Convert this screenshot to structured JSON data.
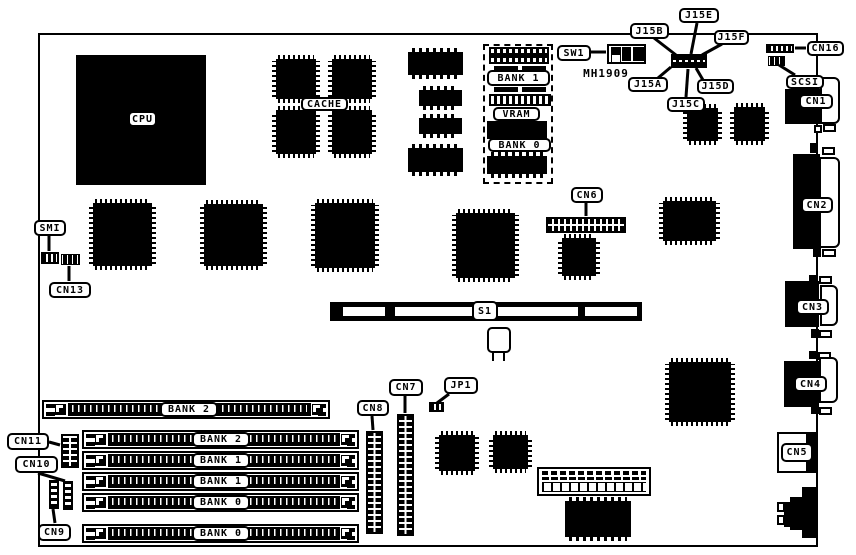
{
  "chips": {
    "cpu": "CPU",
    "cache": "CACHE"
  },
  "video": {
    "bank1": "BANK 1",
    "vram": "VRAM",
    "bank0": "BANK 0"
  },
  "sw": {
    "sw1": "SW1",
    "part": "MH1909"
  },
  "j": {
    "a": "J15A",
    "b": "J15B",
    "c": "J15C",
    "d": "J15D",
    "e": "J15E",
    "f": "J15F",
    "jp1": "JP1"
  },
  "s1": "S1",
  "cn": {
    "c1": "CN1",
    "c2": "CN2",
    "c3": "CN3",
    "c4": "CN4",
    "c5": "CN5",
    "c6": "CN6",
    "c7": "CN7",
    "c8": "CN8",
    "c9": "CN9",
    "c10": "CN10",
    "c11": "CN11",
    "c13": "CN13",
    "c16": "CN16",
    "scsi": "SCSI",
    "smi": "SMI"
  },
  "mem": {
    "top": "BANK 2",
    "r1": "BANK 2",
    "r2": "BANK 1",
    "r3": "BANK 1",
    "r4": "BANK 0",
    "bot": "BANK 0"
  },
  "colors": {
    "ink": "#000000",
    "paper": "#ffffff"
  }
}
